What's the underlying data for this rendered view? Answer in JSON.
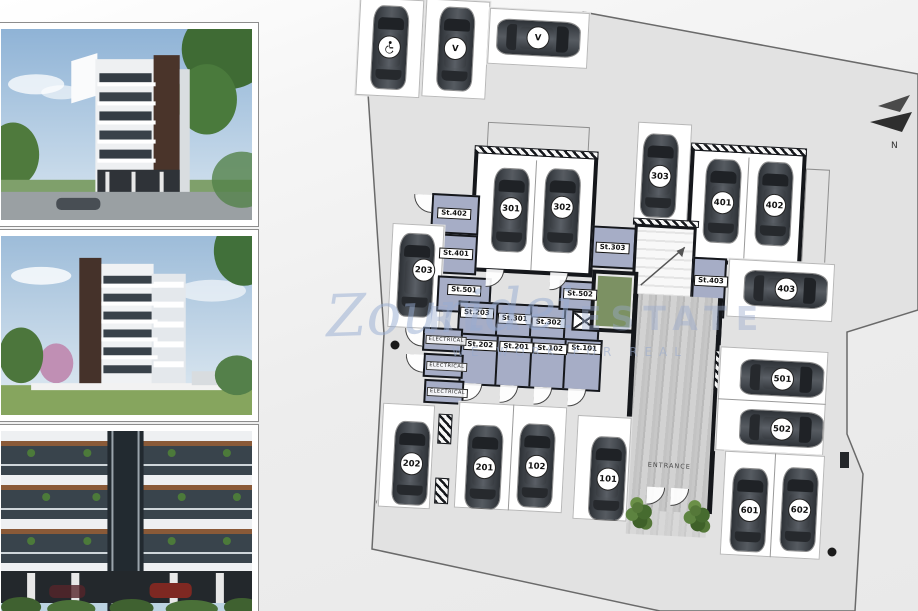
{
  "watermark": {
    "brand_script": "Zouridei",
    "brand_caps": "REAL ESTATE",
    "tagline": "WE WORK FOR REAL"
  },
  "compass": {
    "north_label": "N"
  },
  "plan": {
    "entrance_label": "ENTRANCE",
    "visitor_stalls": [
      {
        "kind": "accessible",
        "icon": "wheelchair-icon"
      },
      {
        "kind": "visitor",
        "badge": "V"
      },
      {
        "kind": "visitor",
        "badge": "V"
      }
    ],
    "stalls": [
      {
        "label": "301"
      },
      {
        "label": "302"
      },
      {
        "label": "303"
      },
      {
        "label": "401"
      },
      {
        "label": "402"
      },
      {
        "label": "403"
      },
      {
        "label": "203"
      },
      {
        "label": "501"
      },
      {
        "label": "502"
      },
      {
        "label": "601"
      },
      {
        "label": "602"
      },
      {
        "label": "101"
      },
      {
        "label": "202"
      },
      {
        "label": "201"
      },
      {
        "label": "102"
      }
    ],
    "storage_rooms": [
      {
        "label": "St.402"
      },
      {
        "label": "St.401"
      },
      {
        "label": "St.501"
      },
      {
        "label": "St.203"
      },
      {
        "label": "St.301"
      },
      {
        "label": "St.302"
      },
      {
        "label": "St.502"
      },
      {
        "label": "St.303"
      },
      {
        "label": "St.403"
      },
      {
        "label": "St.202"
      },
      {
        "label": "St.201"
      },
      {
        "label": "St.102"
      },
      {
        "label": "St.101"
      }
    ],
    "electrical_rooms": [
      {
        "label": "ELECTRICAL"
      },
      {
        "label": "ELECTRICAL"
      },
      {
        "label": "ELECTRICAL"
      }
    ]
  },
  "colors": {
    "storage_fill": "#a6adc6",
    "elevator_green": "#7c9163",
    "site_gray": "#e2e2e2",
    "wall": "#15171b",
    "watermark_blue": "#96acd2"
  }
}
